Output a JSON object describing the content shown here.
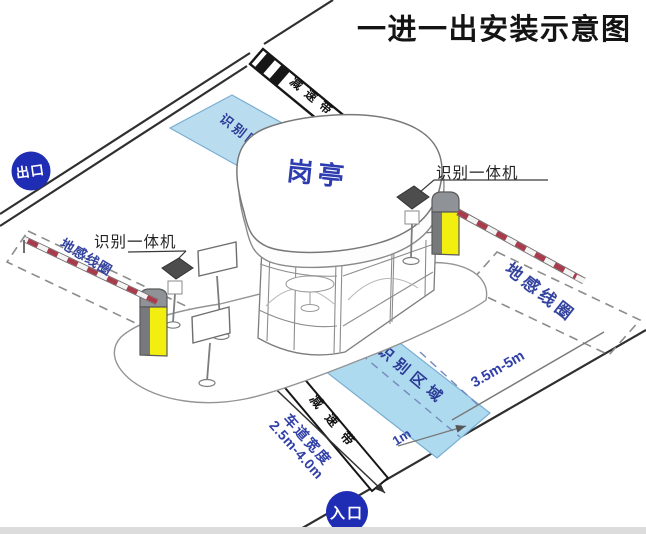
{
  "title": "一进一出安装示意图",
  "badges": {
    "exit": "出口",
    "entrance": "入口"
  },
  "booth": {
    "label": "岗亭"
  },
  "labels": {
    "camera_left": "识别一体机",
    "camera_right": "识别一体机",
    "loop_left": "地感线圈",
    "loop_right": "地感线圈",
    "recognition_top": "识别区域",
    "recognition_bottom": "识别区域",
    "speed_bump_top": "减速带",
    "speed_bump_bottom": "减速带"
  },
  "dimensions": {
    "loop_to_area": "3.5m-5m",
    "area_offset": "1m",
    "lane_width_label": "车道宽度",
    "lane_width_value": "2.5m-4.0m"
  },
  "colors": {
    "badge_blue": "#1f2cb4",
    "label_blue": "#3140a8",
    "zone_blue_fill": "#b9dcef",
    "zone_text_blue": "#2c3c96",
    "barrier_yellow": "#f1ee10",
    "arm_red": "#a83c4c",
    "machine_gray": "#8f9296"
  }
}
